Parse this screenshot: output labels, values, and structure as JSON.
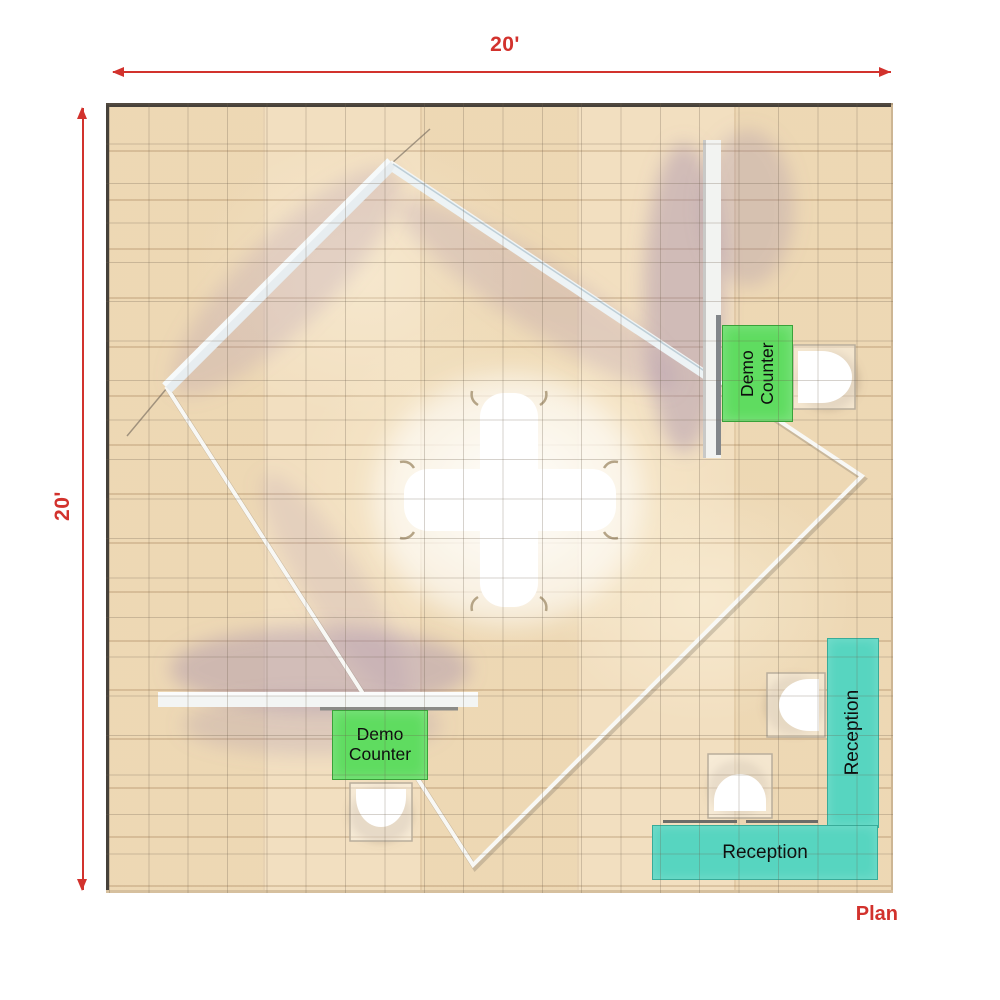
{
  "annotations": {
    "width_dimension": "20'",
    "height_dimension": "20'",
    "plan_caption": "Plan",
    "dimension_color": "#d2322d"
  },
  "booth": {
    "demo_counter_right_label": "Demo Counter",
    "demo_counter_bottom_label": "Demo Counter",
    "reception_vertical_label": "Reception",
    "reception_horizontal_label": "Reception",
    "demo_counter_color": "#5fdc60",
    "reception_color": "#57d5c0",
    "label_text_color": "#0e0e0e"
  },
  "floor": {
    "width_feet": 20,
    "depth_feet": 20,
    "grid_cell_feet": 1
  }
}
